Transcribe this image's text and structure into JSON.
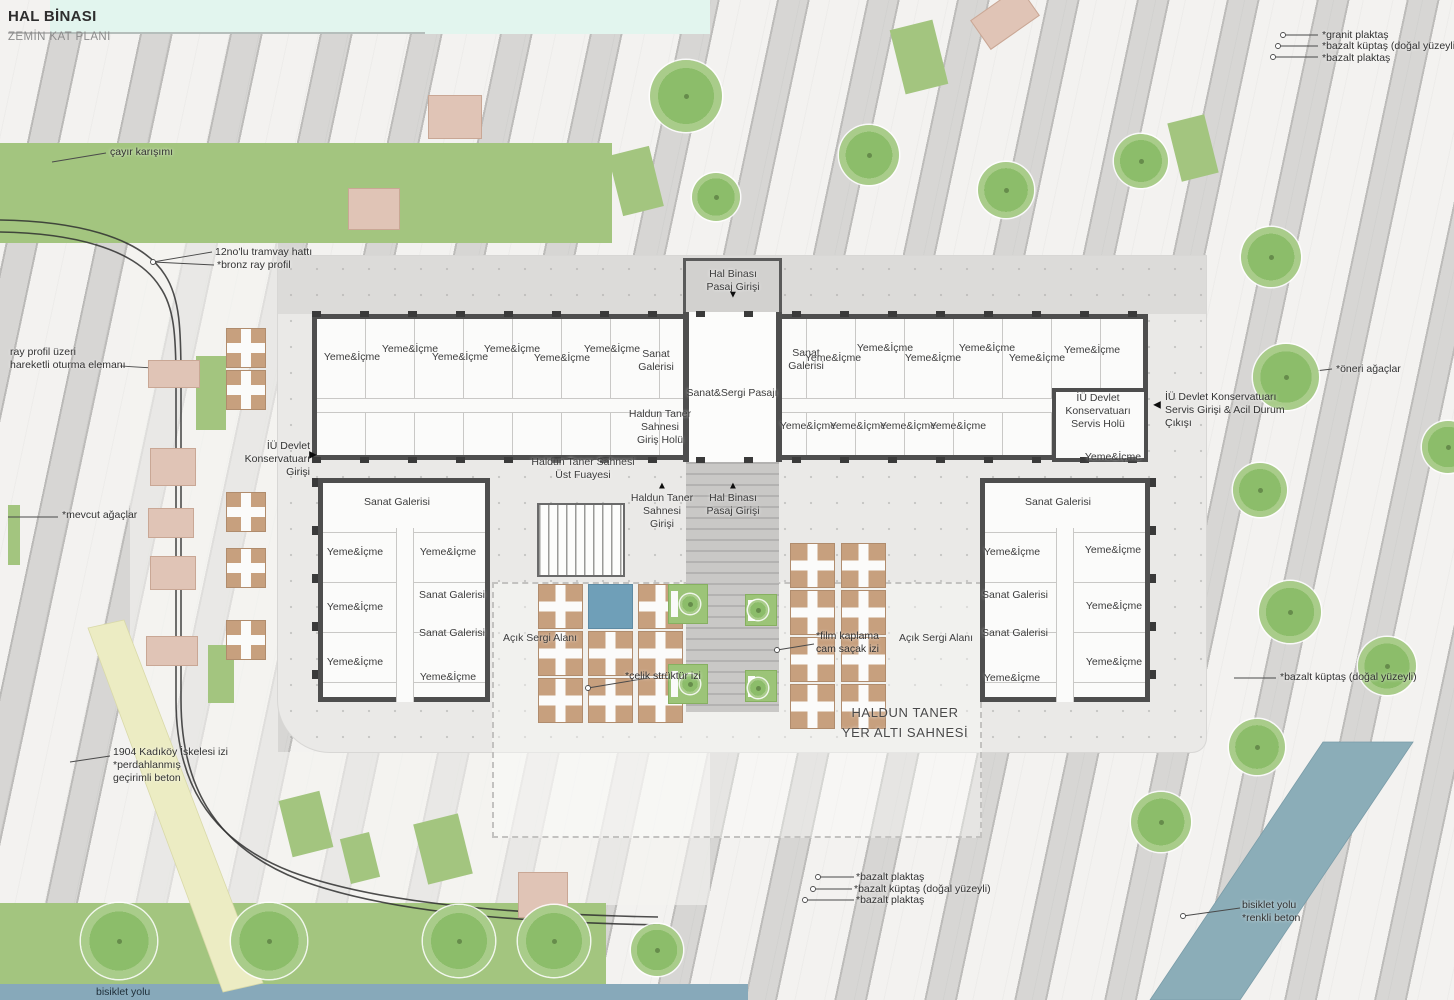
{
  "title": {
    "line1": "HAL BİNASI",
    "line2": "ZEMİN KAT PLANI"
  },
  "colors": {
    "lawn": "#a3c57f",
    "tree": "#8cbd6a",
    "paving_light": "#f3f2f0",
    "paving_band": "#d7d6d4",
    "plaza": "#eae9e7",
    "wall": "#4e4e4e",
    "wood_deck": "#c7a07e",
    "water_blue": "#6f9fb8",
    "bike_path_teal": "#8badb8",
    "bike_band_blue": "#87a9ba",
    "seat_pink": "#e0c4b6",
    "sea_strip": "#e2f5ee",
    "path_yellow": "#ececc3"
  },
  "plan": {
    "room_labels": [
      {
        "lines": [
          "Yeme&İçme"
        ],
        "x": 352,
        "y": 351
      },
      {
        "lines": [
          "Yeme&İçme"
        ],
        "x": 410,
        "y": 343
      },
      {
        "lines": [
          "Yeme&İçme"
        ],
        "x": 460,
        "y": 351
      },
      {
        "lines": [
          "Yeme&İçme"
        ],
        "x": 512,
        "y": 343
      },
      {
        "lines": [
          "Yeme&İçme"
        ],
        "x": 562,
        "y": 352
      },
      {
        "lines": [
          "Yeme&İçme"
        ],
        "x": 612,
        "y": 343
      },
      {
        "lines": [
          "Sanat",
          "Galerisi"
        ],
        "x": 656,
        "y": 348
      },
      {
        "lines": [
          "Sanat&Sergi Pasajı"
        ],
        "x": 732,
        "y": 387
      },
      {
        "lines": [
          "Sanat",
          "Galerisi"
        ],
        "x": 806,
        "y": 347
      },
      {
        "lines": [
          "Yeme&İçme"
        ],
        "x": 833,
        "y": 352
      },
      {
        "lines": [
          "Yeme&İçme"
        ],
        "x": 885,
        "y": 342
      },
      {
        "lines": [
          "Yeme&İçme"
        ],
        "x": 933,
        "y": 352
      },
      {
        "lines": [
          "Yeme&İçme"
        ],
        "x": 987,
        "y": 342
      },
      {
        "lines": [
          "Yeme&İçme"
        ],
        "x": 1037,
        "y": 352
      },
      {
        "lines": [
          "Yeme&İçme"
        ],
        "x": 1092,
        "y": 344
      },
      {
        "lines": [
          "Yeme&İçme"
        ],
        "x": 808,
        "y": 420
      },
      {
        "lines": [
          "Yeme&İçme"
        ],
        "x": 858,
        "y": 420
      },
      {
        "lines": [
          "Yeme&İçme"
        ],
        "x": 908,
        "y": 420
      },
      {
        "lines": [
          "Yeme&İçme"
        ],
        "x": 958,
        "y": 420
      },
      {
        "lines": [
          "İÜ Devlet",
          "Konservatuarı",
          "Servis Holü"
        ],
        "x": 1098,
        "y": 392
      },
      {
        "lines": [
          "Yeme&İçme"
        ],
        "x": 1113,
        "y": 451
      },
      {
        "lines": [
          "Haldun Taner",
          "Sahnesi",
          "Giriş Holü"
        ],
        "x": 660,
        "y": 408
      },
      {
        "lines": [
          "Haldun Taner Sahnesi",
          "Üst Fuayesi"
        ],
        "x": 583,
        "y": 456
      },
      {
        "lines": [
          "Haldun Taner",
          "Sahnesi",
          "Girişi"
        ],
        "x": 662,
        "y": 492
      },
      {
        "lines": [
          "Hal Binası",
          "Pasaj Girişi"
        ],
        "x": 733,
        "y": 492
      },
      {
        "lines": [
          "Hal Binası",
          "Pasaj Girişi"
        ],
        "x": 733,
        "y": 268
      },
      {
        "lines": [
          "Sanat Galerisi"
        ],
        "x": 397,
        "y": 496
      },
      {
        "lines": [
          "Yeme&İçme"
        ],
        "x": 355,
        "y": 546
      },
      {
        "lines": [
          "Yeme&İçme"
        ],
        "x": 448,
        "y": 546
      },
      {
        "lines": [
          "Sanat Galerisi"
        ],
        "x": 452,
        "y": 589
      },
      {
        "lines": [
          "Yeme&İçme"
        ],
        "x": 355,
        "y": 601
      },
      {
        "lines": [
          "Sanat Galerisi"
        ],
        "x": 452,
        "y": 627
      },
      {
        "lines": [
          "Yeme&İçme"
        ],
        "x": 355,
        "y": 656
      },
      {
        "lines": [
          "Yeme&İçme"
        ],
        "x": 448,
        "y": 671
      },
      {
        "lines": [
          "Sanat Galerisi"
        ],
        "x": 1058,
        "y": 496
      },
      {
        "lines": [
          "Yeme&İçme"
        ],
        "x": 1012,
        "y": 546
      },
      {
        "lines": [
          "Yeme&İçme"
        ],
        "x": 1113,
        "y": 544
      },
      {
        "lines": [
          "Sanat Galerisi"
        ],
        "x": 1015,
        "y": 589
      },
      {
        "lines": [
          "Yeme&İçme"
        ],
        "x": 1114,
        "y": 600
      },
      {
        "lines": [
          "Sanat Galerisi"
        ],
        "x": 1015,
        "y": 627
      },
      {
        "lines": [
          "Yeme&İçme"
        ],
        "x": 1114,
        "y": 656
      },
      {
        "lines": [
          "Yeme&İçme"
        ],
        "x": 1012,
        "y": 672
      },
      {
        "lines": [
          "Açık Sergi Alanı"
        ],
        "x": 540,
        "y": 632
      },
      {
        "lines": [
          "Açık Sergi Alanı"
        ],
        "x": 936,
        "y": 632
      },
      {
        "lines": [
          "HALDUN TANER",
          "YER ALTI SAHNESİ"
        ],
        "x": 905,
        "y": 703,
        "cls": "big"
      }
    ],
    "annotations": [
      {
        "lines": [
          "çayır karışımı"
        ],
        "x": 110,
        "y": 146
      },
      {
        "lines": [
          "12no'lu tramvay hattı"
        ],
        "x": 215,
        "y": 246
      },
      {
        "lines": [
          "*bronz ray profil"
        ],
        "x": 217,
        "y": 259
      },
      {
        "lines": [
          "ray profil üzeri",
          "hareketli oturma elemanı"
        ],
        "x": 10,
        "y": 346
      },
      {
        "lines": [
          "İÜ Devlet",
          "Konservatuarı",
          "Girişi"
        ],
        "x": 310,
        "y": 440,
        "align": "right"
      },
      {
        "lines": [
          "*mevcut ağaçlar"
        ],
        "x": 62,
        "y": 509
      },
      {
        "lines": [
          "1904 Kadıköy İskelesi izi",
          "*perdahlanmış",
          "geçirimli beton"
        ],
        "x": 113,
        "y": 746
      },
      {
        "lines": [
          "*granit plaktaş"
        ],
        "x": 1322,
        "y": 29
      },
      {
        "lines": [
          "*bazalt küptaş (doğal yüzeyli)"
        ],
        "x": 1322,
        "y": 40
      },
      {
        "lines": [
          "*bazalt plaktaş"
        ],
        "x": 1322,
        "y": 52
      },
      {
        "lines": [
          "*öneri ağaçlar"
        ],
        "x": 1336,
        "y": 363
      },
      {
        "lines": [
          "İÜ Devlet Konservatuarı",
          "Servis Girişi & Acil Durum",
          "Çıkışı"
        ],
        "x": 1165,
        "y": 391
      },
      {
        "lines": [
          "*bazalt küptaş (doğal yüzeyli)"
        ],
        "x": 1280,
        "y": 671
      },
      {
        "lines": [
          "*bazalt plaktaş"
        ],
        "x": 856,
        "y": 871
      },
      {
        "lines": [
          "*bazalt küptaş (doğal yüzeyli)"
        ],
        "x": 854,
        "y": 883
      },
      {
        "lines": [
          "*bazalt plaktaş"
        ],
        "x": 856,
        "y": 894
      },
      {
        "lines": [
          "bisiklet yolu",
          "*renkli beton"
        ],
        "x": 1242,
        "y": 899
      },
      {
        "lines": [
          "bisiklet yolu"
        ],
        "x": 96,
        "y": 986,
        "cls": "dark"
      },
      {
        "lines": [
          "*çelik strüktür izi"
        ],
        "x": 625,
        "y": 670
      },
      {
        "lines": [
          "*film kaplama",
          "cam saçak izi"
        ],
        "x": 816,
        "y": 630
      }
    ],
    "arrows": [
      {
        "x": 313,
        "y": 455,
        "dir": "right"
      },
      {
        "x": 1157,
        "y": 405,
        "dir": "left"
      },
      {
        "x": 733,
        "y": 295,
        "dir": "down"
      },
      {
        "x": 662,
        "y": 486,
        "dir": "up"
      },
      {
        "x": 733,
        "y": 486,
        "dir": "up"
      }
    ],
    "trees": [
      {
        "x": 686,
        "y": 96,
        "r": 36
      },
      {
        "x": 869,
        "y": 155,
        "r": 30
      },
      {
        "x": 1006,
        "y": 190,
        "r": 28
      },
      {
        "x": 716,
        "y": 197,
        "r": 24
      },
      {
        "x": 1141,
        "y": 161,
        "r": 27
      },
      {
        "x": 1271,
        "y": 257,
        "r": 30
      },
      {
        "x": 1286,
        "y": 377,
        "r": 33
      },
      {
        "x": 1448,
        "y": 447,
        "r": 26
      },
      {
        "x": 1260,
        "y": 490,
        "r": 27
      },
      {
        "x": 1290,
        "y": 612,
        "r": 31
      },
      {
        "x": 1387,
        "y": 666,
        "r": 29
      },
      {
        "x": 1257,
        "y": 747,
        "r": 28
      },
      {
        "x": 1161,
        "y": 822,
        "r": 30
      },
      {
        "x": 119,
        "y": 941,
        "r": 38
      },
      {
        "x": 269,
        "y": 941,
        "r": 38
      },
      {
        "x": 459,
        "y": 941,
        "r": 36
      },
      {
        "x": 554,
        "y": 941,
        "r": 36
      },
      {
        "x": 657,
        "y": 950,
        "r": 26
      },
      {
        "x": 690,
        "y": 604,
        "r": 10
      },
      {
        "x": 690,
        "y": 684,
        "r": 10
      },
      {
        "x": 758,
        "y": 610,
        "r": 10
      },
      {
        "x": 758,
        "y": 688,
        "r": 10
      }
    ],
    "green_patches": [
      {
        "x": 897,
        "y": 24,
        "w": 44,
        "h": 66,
        "rot": -14
      },
      {
        "x": 1174,
        "y": 118,
        "w": 38,
        "h": 60,
        "rot": -14
      },
      {
        "x": 615,
        "y": 150,
        "w": 42,
        "h": 62,
        "rot": -14
      },
      {
        "x": 196,
        "y": 356,
        "w": 30,
        "h": 74,
        "rot": 0
      },
      {
        "x": 208,
        "y": 645,
        "w": 26,
        "h": 58,
        "rot": 0
      },
      {
        "x": 285,
        "y": 795,
        "w": 42,
        "h": 58,
        "rot": -14
      },
      {
        "x": 420,
        "y": 818,
        "w": 46,
        "h": 62,
        "rot": -14
      },
      {
        "x": 345,
        "y": 835,
        "w": 30,
        "h": 46,
        "rot": -14
      },
      {
        "x": 8,
        "y": 505,
        "w": 12,
        "h": 60,
        "rot": 0
      }
    ],
    "seats": [
      {
        "x": 148,
        "y": 360,
        "w": 52,
        "h": 28
      },
      {
        "x": 150,
        "y": 448,
        "w": 46,
        "h": 38
      },
      {
        "x": 148,
        "y": 508,
        "w": 46,
        "h": 30
      },
      {
        "x": 150,
        "y": 556,
        "w": 46,
        "h": 34
      },
      {
        "x": 146,
        "y": 636,
        "w": 52,
        "h": 30
      },
      {
        "x": 428,
        "y": 95,
        "w": 54,
        "h": 44
      },
      {
        "x": 348,
        "y": 188,
        "w": 52,
        "h": 42
      },
      {
        "x": 518,
        "y": 872,
        "w": 50,
        "h": 46
      },
      {
        "x": 975,
        "y": 0,
        "w": 60,
        "h": 36,
        "rot": -35
      }
    ],
    "wood_tables": [
      {
        "x": 226,
        "y": 328,
        "size": 40
      },
      {
        "x": 226,
        "y": 370,
        "size": 40
      },
      {
        "x": 226,
        "y": 492,
        "size": 40
      },
      {
        "x": 226,
        "y": 548,
        "size": 40
      },
      {
        "x": 226,
        "y": 620,
        "size": 40
      }
    ],
    "deck_squares": [
      {
        "x": 538,
        "y": 584,
        "size": 45,
        "kind": "wood"
      },
      {
        "x": 588,
        "y": 584,
        "size": 45,
        "kind": "blue"
      },
      {
        "x": 638,
        "y": 584,
        "size": 45,
        "kind": "wood"
      },
      {
        "x": 538,
        "y": 631,
        "size": 45,
        "kind": "wood"
      },
      {
        "x": 588,
        "y": 631,
        "size": 45,
        "kind": "wood"
      },
      {
        "x": 638,
        "y": 631,
        "size": 45,
        "kind": "wood"
      },
      {
        "x": 538,
        "y": 678,
        "size": 45,
        "kind": "wood"
      },
      {
        "x": 588,
        "y": 678,
        "size": 45,
        "kind": "wood"
      },
      {
        "x": 638,
        "y": 678,
        "size": 45,
        "kind": "wood"
      },
      {
        "x": 668,
        "y": 584,
        "size": 40,
        "kind": "green"
      },
      {
        "x": 668,
        "y": 664,
        "size": 40,
        "kind": "green"
      },
      {
        "x": 745,
        "y": 594,
        "size": 32,
        "kind": "green"
      },
      {
        "x": 745,
        "y": 670,
        "size": 32,
        "kind": "green"
      },
      {
        "x": 790,
        "y": 543,
        "size": 45,
        "kind": "wood"
      },
      {
        "x": 841,
        "y": 543,
        "size": 45,
        "kind": "wood"
      },
      {
        "x": 790,
        "y": 590,
        "size": 45,
        "kind": "wood"
      },
      {
        "x": 841,
        "y": 590,
        "size": 45,
        "kind": "wood"
      },
      {
        "x": 790,
        "y": 637,
        "size": 45,
        "kind": "wood"
      },
      {
        "x": 841,
        "y": 637,
        "size": 45,
        "kind": "wood"
      },
      {
        "x": 790,
        "y": 684,
        "size": 45,
        "kind": "wood"
      },
      {
        "x": 841,
        "y": 684,
        "size": 45,
        "kind": "wood"
      }
    ]
  }
}
